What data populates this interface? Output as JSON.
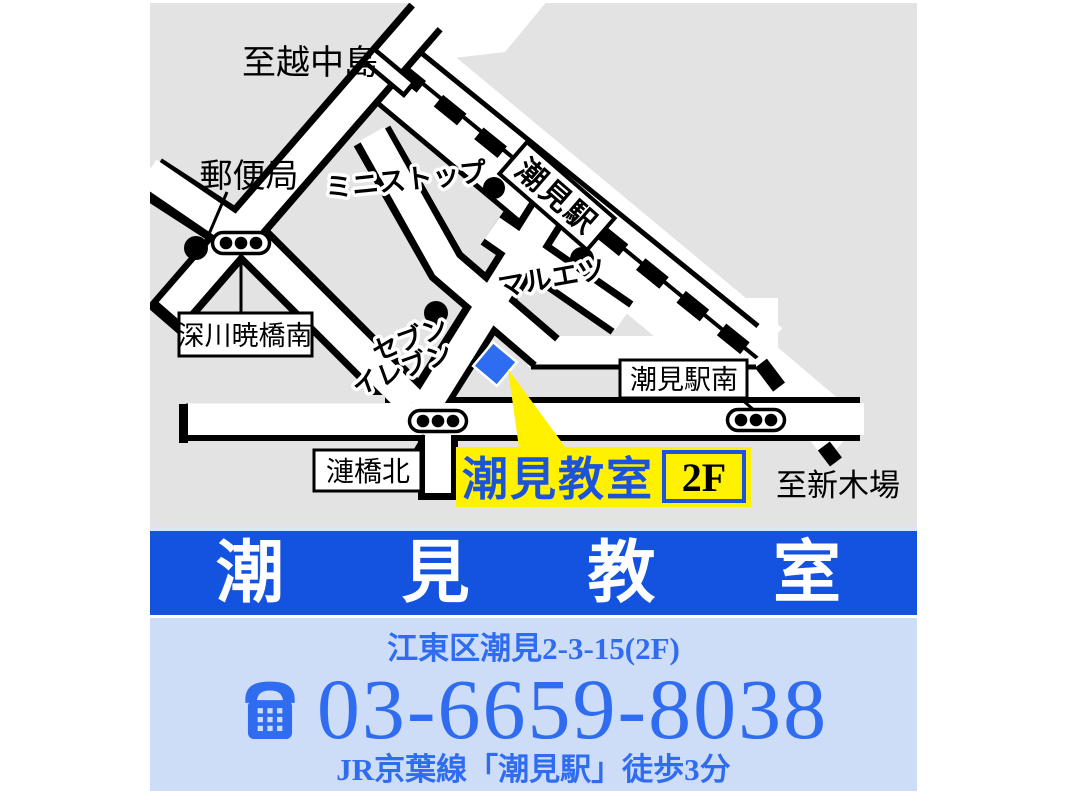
{
  "map": {
    "dest_top": "至越中島",
    "dest_bottom": "至新木場",
    "post_office": "郵便局",
    "ministop": "ミニストップ",
    "maruetsu": "マルエツ",
    "seven1": "セブン",
    "seven2": "イレブン",
    "station": "潮見駅",
    "box_fukagawa": "深川暁橋南",
    "box_sazanami": "漣橋北",
    "box_station_south": "潮見駅南",
    "target_label": "潮見教室",
    "target_floor": "2F"
  },
  "banner": {
    "c1": "潮",
    "c2": "見",
    "c3": "教",
    "c4": "室"
  },
  "contact": {
    "address": "江東区潮見2-3-15(2F)",
    "phone": "03-6659-8038",
    "access": "JR京葉線「潮見駅」徒歩3分"
  },
  "colors": {
    "map_gray": "#e3e3e4",
    "banner_blue": "#1353e0",
    "panel_blue": "#cddcf7",
    "text_blue": "#2f6cf0",
    "marker_blue": "#2e6cf2",
    "highlight_yellow": "#fff100"
  }
}
